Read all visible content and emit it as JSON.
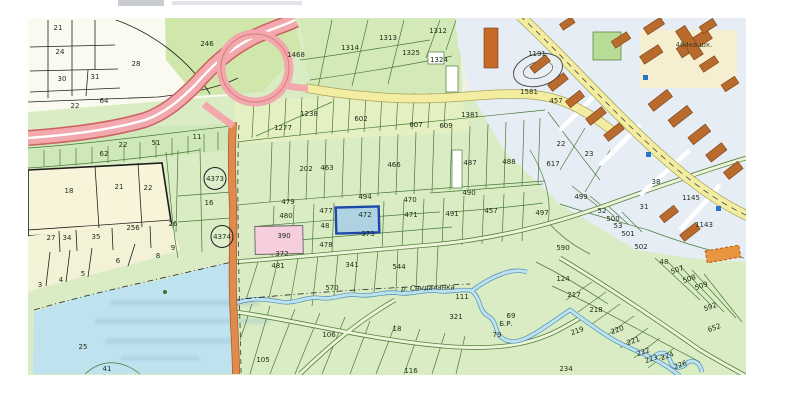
{
  "map": {
    "kind": "scanned-cadastral-map",
    "highlighted": {
      "selected_parcel": "472",
      "pink_parcel": "390",
      "survey_marks": [
        "4373",
        "4374"
      ]
    },
    "colors": {
      "paper": "#ffffff",
      "field_green": "#d9ecc4",
      "field_pale": "#e6f0c6",
      "field_cream": "#f7f4dc",
      "white_fields": "#fbfaf1",
      "urban_bg": "#e6edf4",
      "water": "#bfe2ef",
      "highway_pink": "#f2a8ac",
      "highway_casing": "#cd6060",
      "road_yellow": "#f3eda2",
      "road_orange": "#e08a4e",
      "building_brown": "#b96a2d",
      "selected_fill": "#aed2e2",
      "selected_border": "#1d47a8",
      "pink_parcel_fill": "#f6cede",
      "boundary_green": "#4a7a38",
      "ink": "#20301a"
    },
    "labels": [
      {
        "t": "21",
        "x": 58,
        "y": 30
      },
      {
        "t": "24",
        "x": 60,
        "y": 54
      },
      {
        "t": "28",
        "x": 136,
        "y": 66,
        "s": 8
      },
      {
        "t": "30",
        "x": 62,
        "y": 81
      },
      {
        "t": "31",
        "x": 95,
        "y": 79
      },
      {
        "t": "22",
        "x": 75,
        "y": 108
      },
      {
        "t": "64",
        "x": 104,
        "y": 103
      },
      {
        "t": "246",
        "x": 207,
        "y": 46,
        "s": 8
      },
      {
        "t": "1468",
        "x": 296,
        "y": 57
      },
      {
        "t": "1314",
        "x": 350,
        "y": 50
      },
      {
        "t": "1313",
        "x": 388,
        "y": 40
      },
      {
        "t": "1312",
        "x": 438,
        "y": 33
      },
      {
        "t": "1325",
        "x": 411,
        "y": 55
      },
      {
        "t": "1324",
        "x": 439,
        "y": 62
      },
      {
        "t": "1381",
        "x": 470,
        "y": 117
      },
      {
        "t": "1238",
        "x": 309,
        "y": 116
      },
      {
        "t": "1277",
        "x": 283,
        "y": 130
      },
      {
        "t": "602",
        "x": 361,
        "y": 121
      },
      {
        "t": "607",
        "x": 416,
        "y": 127
      },
      {
        "t": "609",
        "x": 446,
        "y": 128
      },
      {
        "t": "1581",
        "x": 529,
        "y": 94
      },
      {
        "t": "1191",
        "x": 537,
        "y": 56
      },
      {
        "t": "457",
        "x": 556,
        "y": 103
      },
      {
        "t": "464кв.шк.",
        "x": 694,
        "y": 47,
        "s": 5,
        "c": "#5c4632",
        "st": "faint"
      },
      {
        "t": "11",
        "x": 197,
        "y": 139
      },
      {
        "t": "51",
        "x": 156,
        "y": 145
      },
      {
        "t": "22",
        "x": 123,
        "y": 147
      },
      {
        "t": "62",
        "x": 104,
        "y": 156
      },
      {
        "t": "18",
        "x": 69,
        "y": 193,
        "s": 8
      },
      {
        "t": "21",
        "x": 119,
        "y": 189,
        "s": 8
      },
      {
        "t": "22",
        "x": 148,
        "y": 190,
        "s": 8
      },
      {
        "t": "16",
        "x": 209,
        "y": 205
      },
      {
        "t": "4373",
        "x": 215,
        "y": 181,
        "st": "circled"
      },
      {
        "t": "4374",
        "x": 222,
        "y": 239,
        "st": "circled"
      },
      {
        "t": "26",
        "x": 173,
        "y": 226
      },
      {
        "t": "256",
        "x": 133,
        "y": 230,
        "s": 6
      },
      {
        "t": "27",
        "x": 51,
        "y": 240
      },
      {
        "t": "34",
        "x": 67,
        "y": 240
      },
      {
        "t": "35",
        "x": 96,
        "y": 239
      },
      {
        "t": "3",
        "x": 40,
        "y": 287
      },
      {
        "t": "4",
        "x": 61,
        "y": 282
      },
      {
        "t": "5",
        "x": 83,
        "y": 276
      },
      {
        "t": "6",
        "x": 118,
        "y": 263
      },
      {
        "t": "8",
        "x": 158,
        "y": 258
      },
      {
        "t": "9",
        "x": 173,
        "y": 250
      },
      {
        "t": "25",
        "x": 83,
        "y": 349,
        "s": 8
      },
      {
        "t": "41",
        "x": 107,
        "y": 371
      },
      {
        "t": "202",
        "x": 306,
        "y": 171
      },
      {
        "t": "463",
        "x": 327,
        "y": 170
      },
      {
        "t": "466",
        "x": 394,
        "y": 167
      },
      {
        "t": "487",
        "x": 470,
        "y": 165
      },
      {
        "t": "488",
        "x": 509,
        "y": 164
      },
      {
        "t": "490",
        "x": 469,
        "y": 195
      },
      {
        "t": "470",
        "x": 410,
        "y": 202
      },
      {
        "t": "494",
        "x": 365,
        "y": 199
      },
      {
        "t": "471",
        "x": 411,
        "y": 217
      },
      {
        "t": "491",
        "x": 452,
        "y": 216
      },
      {
        "t": "457",
        "x": 491,
        "y": 213
      },
      {
        "t": "479",
        "x": 288,
        "y": 204
      },
      {
        "t": "480",
        "x": 286,
        "y": 218
      },
      {
        "t": "477",
        "x": 326,
        "y": 213
      },
      {
        "t": "472",
        "x": 365,
        "y": 217,
        "s": 8
      },
      {
        "t": "48",
        "x": 325,
        "y": 228,
        "s": 6
      },
      {
        "t": "390",
        "x": 284,
        "y": 238
      },
      {
        "t": "373",
        "x": 368,
        "y": 236,
        "s": 6
      },
      {
        "t": "478",
        "x": 326,
        "y": 247
      },
      {
        "t": "372",
        "x": 282,
        "y": 256
      },
      {
        "t": "481",
        "x": 278,
        "y": 268
      },
      {
        "t": "341",
        "x": 352,
        "y": 267
      },
      {
        "t": "544",
        "x": 399,
        "y": 269
      },
      {
        "t": "570",
        "x": 332,
        "y": 290
      },
      {
        "t": "106",
        "x": 329,
        "y": 337
      },
      {
        "t": "105",
        "x": 263,
        "y": 362
      },
      {
        "t": "111",
        "x": 462,
        "y": 299
      },
      {
        "t": "321",
        "x": 456,
        "y": 319
      },
      {
        "t": "18",
        "x": 397,
        "y": 331
      },
      {
        "t": "116",
        "x": 411,
        "y": 373
      },
      {
        "t": "69",
        "x": 511,
        "y": 318,
        "s": 6
      },
      {
        "t": "Б.Р.",
        "x": 506,
        "y": 326,
        "s": 6
      },
      {
        "t": "79",
        "x": 497,
        "y": 337,
        "s": 6
      },
      {
        "t": "22",
        "x": 561,
        "y": 146
      },
      {
        "t": "23",
        "x": 589,
        "y": 156
      },
      {
        "t": "617",
        "x": 553,
        "y": 166
      },
      {
        "t": "499",
        "x": 581,
        "y": 199
      },
      {
        "t": "497",
        "x": 542,
        "y": 215
      },
      {
        "t": "52",
        "x": 602,
        "y": 213,
        "s": 6
      },
      {
        "t": "500",
        "x": 613,
        "y": 221
      },
      {
        "t": "53",
        "x": 618,
        "y": 228,
        "s": 6
      },
      {
        "t": "501",
        "x": 628,
        "y": 236
      },
      {
        "t": "502",
        "x": 641,
        "y": 249
      },
      {
        "t": "590",
        "x": 563,
        "y": 250,
        "s": 6
      },
      {
        "t": "38",
        "x": 656,
        "y": 184,
        "s": 6
      },
      {
        "t": "31",
        "x": 644,
        "y": 209,
        "s": 6
      },
      {
        "t": "1145",
        "x": 691,
        "y": 200
      },
      {
        "t": "1143",
        "x": 704,
        "y": 227
      },
      {
        "t": "124",
        "x": 563,
        "y": 281
      },
      {
        "t": "217",
        "x": 574,
        "y": 297
      },
      {
        "t": "218",
        "x": 596,
        "y": 312
      },
      {
        "t": "219",
        "x": 578,
        "y": 333,
        "r": -20
      },
      {
        "t": "220",
        "x": 618,
        "y": 332,
        "r": -20
      },
      {
        "t": "221",
        "x": 634,
        "y": 343,
        "r": -20
      },
      {
        "t": "222",
        "x": 644,
        "y": 354,
        "r": -20
      },
      {
        "t": "223",
        "x": 652,
        "y": 361,
        "r": -20
      },
      {
        "t": "224",
        "x": 668,
        "y": 358,
        "r": -20
      },
      {
        "t": "226",
        "x": 681,
        "y": 367,
        "r": -20
      },
      {
        "t": "234",
        "x": 566,
        "y": 371
      },
      {
        "t": "48",
        "x": 664,
        "y": 264,
        "s": 6
      },
      {
        "t": "507",
        "x": 678,
        "y": 272,
        "r": -20,
        "s": 6
      },
      {
        "t": "508",
        "x": 690,
        "y": 281,
        "r": -20,
        "s": 6
      },
      {
        "t": "509",
        "x": 702,
        "y": 288,
        "r": -20,
        "s": 6
      },
      {
        "t": "592",
        "x": 711,
        "y": 309,
        "r": -20,
        "s": 6
      },
      {
        "t": "652",
        "x": 715,
        "y": 330,
        "r": -20,
        "s": 6
      },
      {
        "t": "р. Сандаланка",
        "x": 428,
        "y": 290,
        "s": 6,
        "c": "#3c6b8e",
        "st": "river",
        "r": -2
      }
    ]
  }
}
